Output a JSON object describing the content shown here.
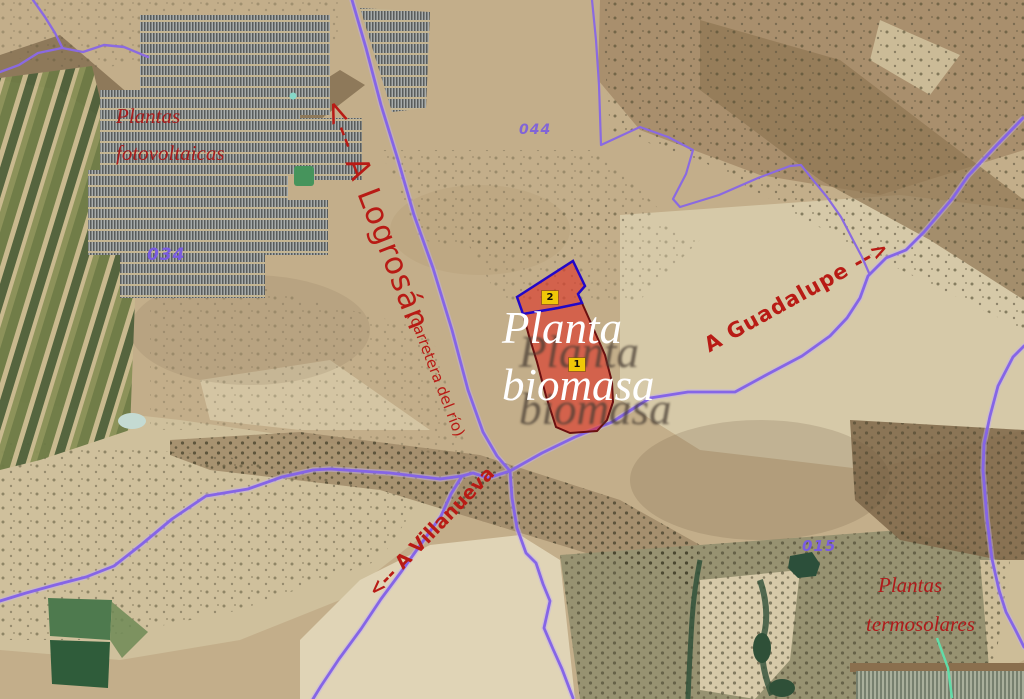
{
  "map": {
    "labels": {
      "photovoltaic": {
        "line1": "Plantas",
        "line2": "fotovoltaicas"
      },
      "logrosan": {
        "road": "<-- A Logrosán",
        "sub": "(carretera del río)"
      },
      "biomass": {
        "line1": "Planta",
        "line2": "biomasa"
      },
      "guadalupe": {
        "road": "A Guadalupe -->"
      },
      "villanueva": {
        "road": "<-- A Villanueva"
      },
      "thermosolar": {
        "line1": "Plantas",
        "line2": "termosolares"
      }
    },
    "parcel_numbers": {
      "left": "034",
      "top": "044",
      "right": "015"
    },
    "site_markers": [
      {
        "id": "1"
      },
      {
        "id": "2"
      }
    ],
    "colors": {
      "annotation_red": "#b81b15",
      "serif_red": "#a81c1c",
      "road_purple": "#8a6ae0",
      "parcel_number_purple": "#7a5ce0",
      "parcel_fill_red": "#e0251a",
      "parcel1_border": "#6b1010",
      "parcel2_border": "#2208c8",
      "marker_yellow": "#f0c808",
      "biomass_text": "#ffffff",
      "terrain_base": "#c3ae8a"
    }
  }
}
